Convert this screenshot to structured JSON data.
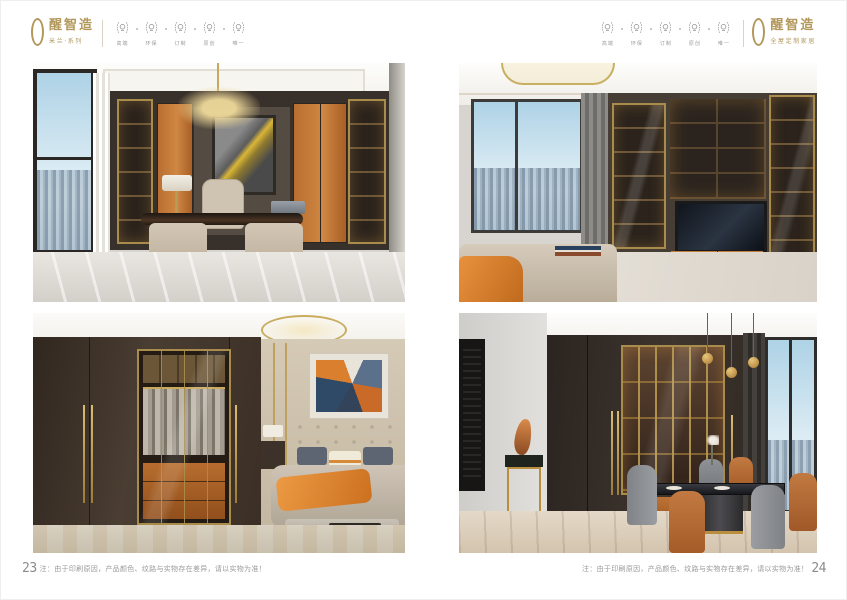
{
  "brand": {
    "name": "醒智造",
    "tagline_left": "米兰·系列",
    "tagline_right": "全屋定制家居"
  },
  "badges": {
    "labels": [
      "高端",
      "环保",
      "订制",
      "原创",
      "唯一"
    ]
  },
  "footer": {
    "left_page_number": "23",
    "right_page_number": "24",
    "note": "注：由于印刷原因，产品颜色、纹路与实物存在差异，请以实物为准！"
  },
  "colors": {
    "brand_gold": "#b3985c",
    "accent_orange": "#c1763c",
    "cabinet_dark": "#3a312a",
    "badge_gray": "#9c9c9c",
    "note_gray": "#9a9a9a"
  }
}
